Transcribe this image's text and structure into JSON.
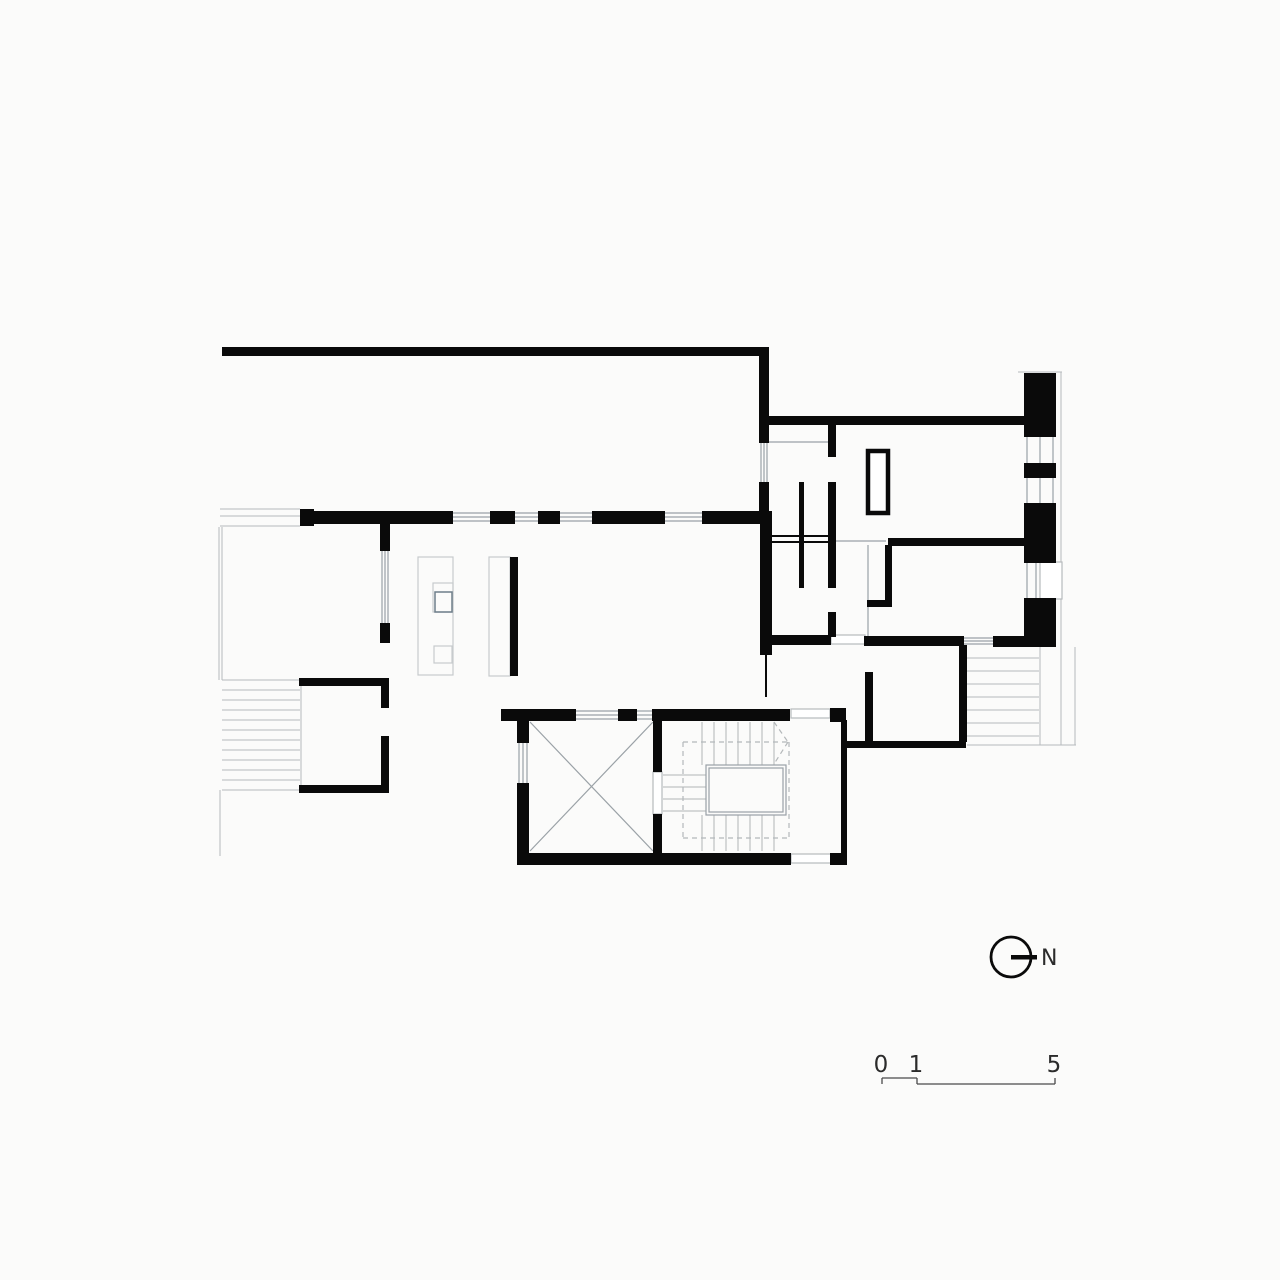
{
  "page": {
    "background": "#fbfbfa",
    "width": 1280,
    "height": 1280
  },
  "palette": {
    "wall": "#0a0a0a",
    "thin": "#9aa1a6",
    "deck": "#b6babc",
    "tread": "#b0b5b7",
    "dashed": "#b4b8ba",
    "furniture": "#c7cbcd",
    "sink": "#6e7e8a",
    "scale_line": "#4a4a4a",
    "text": "#2b2b2b"
  },
  "north": {
    "label": "N",
    "cx": 1011,
    "cy": 957,
    "r": 20,
    "ring_width": 2.8,
    "bar": [
      1011,
      955,
      26,
      4.5
    ],
    "label_x": 1041,
    "label_y": 965
  },
  "scale_bar": {
    "labels": [
      {
        "text": "0",
        "x": 881,
        "y": 1072
      },
      {
        "text": "1",
        "x": 916,
        "y": 1072
      },
      {
        "text": "5",
        "x": 1054,
        "y": 1072
      }
    ],
    "segments": [
      [
        882,
        1078,
        917,
        1078
      ],
      [
        917,
        1078,
        917,
        1084
      ],
      [
        917,
        1084,
        1055,
        1084
      ],
      [
        882,
        1078,
        882,
        1084
      ],
      [
        1055,
        1078,
        1055,
        1084
      ]
    ]
  },
  "plan": {
    "layers": [
      {
        "name": "terrace-deck-line",
        "type": "line",
        "stroke": "#b6babc",
        "stroke_width": 1,
        "items": [
          [
            220,
            509,
            300,
            509
          ],
          [
            220,
            516,
            300,
            516
          ],
          [
            220,
            526,
            300,
            526
          ],
          [
            219,
            527,
            219,
            680
          ],
          [
            222,
            527,
            222,
            680
          ],
          [
            222,
            680,
            300,
            680
          ],
          [
            222,
            690,
            300,
            690
          ],
          [
            222,
            700,
            300,
            700
          ],
          [
            222,
            710,
            300,
            710
          ],
          [
            222,
            720,
            300,
            720
          ],
          [
            222,
            730,
            300,
            730
          ],
          [
            222,
            740,
            300,
            740
          ],
          [
            222,
            750,
            300,
            750
          ],
          [
            222,
            760,
            300,
            760
          ],
          [
            222,
            770,
            300,
            770
          ],
          [
            222,
            780,
            300,
            780
          ],
          [
            222,
            790,
            300,
            790
          ],
          [
            220,
            790,
            220,
            856
          ],
          [
            301,
            686,
            301,
            785
          ],
          [
            967,
            658,
            1039,
            658
          ],
          [
            967,
            671,
            1039,
            671
          ],
          [
            967,
            684,
            1039,
            684
          ],
          [
            967,
            697,
            1039,
            697
          ],
          [
            967,
            710,
            1039,
            710
          ],
          [
            967,
            723,
            1039,
            723
          ],
          [
            967,
            736,
            1039,
            736
          ],
          [
            1040,
            647,
            1040,
            745
          ],
          [
            967,
            745,
            1076,
            745
          ],
          [
            1018,
            372,
            1062,
            372
          ],
          [
            1061,
            372,
            1061,
            745
          ],
          [
            1075,
            647,
            1075,
            745
          ]
        ]
      },
      {
        "name": "window-pane-line",
        "type": "line",
        "stroke": "#9aa1a6",
        "stroke_width": 1.2,
        "items": [
          [
            453,
            513,
            490,
            513
          ],
          [
            453,
            517,
            490,
            517
          ],
          [
            453,
            521,
            490,
            521
          ],
          [
            515,
            513,
            538,
            513
          ],
          [
            515,
            517,
            538,
            517
          ],
          [
            515,
            521,
            538,
            521
          ],
          [
            560,
            513,
            592,
            513
          ],
          [
            560,
            517,
            592,
            517
          ],
          [
            560,
            521,
            592,
            521
          ],
          [
            665,
            513,
            702,
            513
          ],
          [
            665,
            517,
            702,
            517
          ],
          [
            665,
            521,
            702,
            521
          ],
          [
            576,
            711,
            618,
            711
          ],
          [
            576,
            715,
            618,
            715
          ],
          [
            576,
            719,
            618,
            719
          ],
          [
            637,
            711,
            652,
            711
          ],
          [
            637,
            715,
            652,
            715
          ],
          [
            637,
            719,
            652,
            719
          ],
          [
            964,
            638,
            993,
            638
          ],
          [
            964,
            641,
            993,
            641
          ],
          [
            964,
            644,
            993,
            644
          ],
          [
            761,
            443,
            761,
            482
          ],
          [
            764,
            443,
            764,
            482
          ],
          [
            767,
            443,
            767,
            482
          ],
          [
            769,
            442,
            828,
            442
          ],
          [
            382,
            551,
            382,
            623
          ],
          [
            385,
            551,
            385,
            623
          ],
          [
            388,
            551,
            388,
            623
          ],
          [
            519,
            743,
            519,
            783
          ],
          [
            523,
            743,
            523,
            783
          ],
          [
            527,
            743,
            527,
            783
          ],
          [
            1027,
            437,
            1027,
            463
          ],
          [
            1040,
            437,
            1040,
            463
          ],
          [
            1053,
            437,
            1053,
            463
          ],
          [
            1027,
            478,
            1027,
            503
          ],
          [
            1040,
            478,
            1040,
            503
          ],
          [
            1053,
            478,
            1053,
            503
          ],
          [
            1027,
            563,
            1027,
            598
          ],
          [
            1036,
            563,
            1036,
            598
          ],
          [
            836,
            541,
            886,
            541
          ],
          [
            868,
            545,
            868,
            600
          ],
          [
            868,
            607,
            868,
            637
          ]
        ]
      },
      {
        "name": "stair-tread-line",
        "type": "line",
        "stroke": "#b0b5b7",
        "stroke_width": 1,
        "items": [
          [
            702,
            722,
            702,
            765
          ],
          [
            714,
            722,
            714,
            765
          ],
          [
            726,
            722,
            726,
            765
          ],
          [
            738,
            722,
            738,
            765
          ],
          [
            750,
            722,
            750,
            765
          ],
          [
            762,
            722,
            762,
            765
          ],
          [
            774,
            722,
            774,
            765
          ],
          [
            702,
            815,
            702,
            851
          ],
          [
            714,
            815,
            714,
            851
          ],
          [
            726,
            815,
            726,
            851
          ],
          [
            738,
            815,
            738,
            851
          ],
          [
            750,
            815,
            750,
            851
          ],
          [
            762,
            815,
            762,
            851
          ],
          [
            774,
            815,
            774,
            851
          ],
          [
            663,
            775,
            706,
            775
          ],
          [
            663,
            787,
            706,
            787
          ],
          [
            663,
            799,
            706,
            799
          ],
          [
            663,
            811,
            706,
            811
          ]
        ]
      },
      {
        "name": "stair-dashed-line",
        "type": "line",
        "stroke": "#b4b8ba",
        "stroke_width": 1.2,
        "dash": "5,4",
        "items": [
          [
            683,
            742,
            789,
            742
          ],
          [
            683,
            838,
            789,
            838
          ],
          [
            683,
            742,
            683,
            838
          ],
          [
            789,
            742,
            789,
            838
          ],
          [
            774,
            722,
            788,
            742
          ],
          [
            788,
            742,
            774,
            764
          ]
        ]
      },
      {
        "name": "stairwell-outline",
        "type": "rect",
        "stroke": "#9aa1a6",
        "stroke_width": 1.2,
        "fill": "none",
        "items": [
          [
            706,
            765,
            80,
            50
          ],
          [
            709,
            768,
            74,
            44
          ]
        ]
      },
      {
        "name": "void-cross-line",
        "type": "line",
        "stroke": "#9aa1a6",
        "stroke_width": 1.2,
        "items": [
          [
            530,
            722,
            653,
            851
          ],
          [
            653,
            722,
            530,
            851
          ]
        ]
      },
      {
        "name": "door-opening",
        "type": "rect",
        "stroke": "#b6babc",
        "stroke_width": 1.2,
        "fill": "#ffffff",
        "items": [
          [
            831,
            635,
            34,
            9
          ],
          [
            791,
            709,
            39,
            9
          ],
          [
            791,
            854,
            40,
            9
          ],
          [
            653,
            772,
            9,
            42
          ],
          [
            1040,
            562,
            22,
            37
          ]
        ]
      },
      {
        "name": "furniture-outline",
        "type": "rect",
        "stroke": "#c7cbcd",
        "stroke_width": 1.2,
        "fill": "none",
        "items": [
          [
            418,
            557,
            35,
            118
          ],
          [
            489,
            557,
            21,
            119
          ],
          [
            433,
            583,
            20,
            29
          ],
          [
            434,
            646,
            18,
            17
          ]
        ]
      },
      {
        "name": "sink-inner-outline",
        "type": "rect",
        "stroke": "#6e7e8a",
        "stroke_width": 1.5,
        "fill": "none",
        "items": [
          [
            435,
            592,
            17,
            20
          ]
        ]
      },
      {
        "name": "wall-segment",
        "type": "rect",
        "fill": "#0a0a0a",
        "items": [
          [
            222,
            347,
            547,
            9
          ],
          [
            759,
            347,
            10,
            77
          ],
          [
            769,
            416,
            255,
            9
          ],
          [
            1024,
            373,
            32,
            64
          ],
          [
            1024,
            463,
            32,
            15
          ],
          [
            1024,
            503,
            32,
            60
          ],
          [
            1024,
            598,
            32,
            49
          ],
          [
            300,
            509,
            14,
            17
          ],
          [
            300,
            511,
            153,
            13
          ],
          [
            490,
            511,
            25,
            13
          ],
          [
            538,
            511,
            22,
            13
          ],
          [
            592,
            511,
            73,
            13
          ],
          [
            702,
            511,
            66,
            13
          ],
          [
            759,
            424,
            10,
            19
          ],
          [
            759,
            482,
            10,
            29
          ],
          [
            760,
            511,
            12,
            144
          ],
          [
            772,
            635,
            59,
            10
          ],
          [
            864,
            636,
            100,
            10
          ],
          [
            993,
            636,
            31,
            11
          ],
          [
            888,
            538,
            136,
            8
          ],
          [
            828,
            424,
            8,
            33
          ],
          [
            828,
            482,
            8,
            106
          ],
          [
            828,
            612,
            8,
            25
          ],
          [
            799,
            482,
            5,
            106
          ],
          [
            885,
            545,
            7,
            62
          ],
          [
            867,
            600,
            25,
            7
          ],
          [
            865,
            672,
            8,
            70
          ],
          [
            959,
            645,
            8,
            97
          ],
          [
            841,
            741,
            125,
            7
          ],
          [
            841,
            720,
            6,
            145
          ],
          [
            830,
            708,
            16,
            14
          ],
          [
            501,
            709,
            75,
            12
          ],
          [
            618,
            709,
            19,
            12
          ],
          [
            652,
            709,
            138,
            12
          ],
          [
            517,
            709,
            12,
            34
          ],
          [
            517,
            783,
            12,
            82
          ],
          [
            653,
            709,
            9,
            63
          ],
          [
            653,
            814,
            9,
            51
          ],
          [
            517,
            853,
            274,
            12
          ],
          [
            830,
            853,
            17,
            12
          ],
          [
            299,
            678,
            90,
            8
          ],
          [
            381,
            678,
            8,
            30
          ],
          [
            381,
            736,
            8,
            57
          ],
          [
            299,
            785,
            90,
            8
          ],
          [
            380,
            511,
            10,
            40
          ],
          [
            380,
            623,
            10,
            20
          ],
          [
            510,
            557,
            8,
            119
          ]
        ]
      },
      {
        "name": "partition-line",
        "type": "line",
        "stroke": "#0a0a0a",
        "stroke_width": 2,
        "items": [
          [
            772,
            536,
            828,
            536
          ],
          [
            772,
            542,
            828,
            542
          ],
          [
            766,
            655,
            766,
            697
          ]
        ]
      },
      {
        "name": "wardrobe-outline",
        "type": "rect",
        "stroke": "#0a0a0a",
        "stroke_width": 4.5,
        "fill": "#ffffff",
        "items": [
          [
            868,
            451,
            20,
            62
          ]
        ]
      }
    ]
  }
}
